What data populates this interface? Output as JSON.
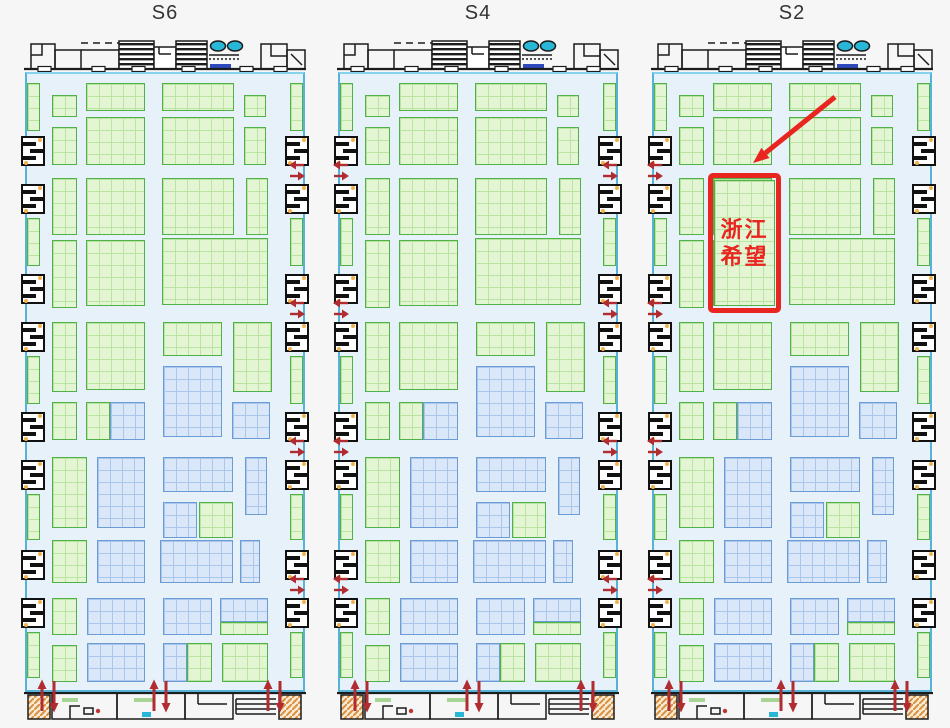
{
  "page": {
    "background": "#f6f6f6"
  },
  "panels": [
    {
      "label": "S6",
      "x": 22
    },
    {
      "label": "S4",
      "x": 335
    },
    {
      "label": "S2",
      "x": 649,
      "highlight": {
        "full_text": "浙江希望",
        "lines": [
          "浙江",
          "希望"
        ],
        "rect": [
          59,
          173,
          73,
          140
        ],
        "booth": [
          65,
          180,
          61,
          126
        ],
        "arrow": {
          "from": [
            186,
            97
          ],
          "to": [
            104,
            163
          ]
        }
      }
    }
  ],
  "colors": {
    "page_bg": "#f6f6f6",
    "hall_bg": "#e6f1fa",
    "hall_border": "#55b2d9",
    "green_fill": "#e3f5d3",
    "green_border": "#4fb148",
    "blue_fill": "#d9e7f8",
    "blue_border": "#6b9cd6",
    "arrow_red": "#b02c30",
    "highlight_red": "#e8251f",
    "cyan_fixture": "#28b7d7",
    "stair_orange": "#d98f3e",
    "escalator_blue": "#2d49bb",
    "wall_black": "#1c1c1c"
  },
  "icons": {
    "two_way_arrow": "two-way-arrow-icon",
    "up_down_arrow": "up-down-arrow-icon",
    "annotation_arrow": "annotation-arrow-icon"
  },
  "floorplan": {
    "hall": {
      "left": 3,
      "top": 72,
      "width": 280,
      "height": 620
    },
    "booths": [
      [
        30,
        95,
        25,
        22,
        "g"
      ],
      [
        30,
        127,
        25,
        38,
        "g"
      ],
      [
        64,
        83,
        59,
        28,
        "g"
      ],
      [
        64,
        117,
        59,
        48,
        "g"
      ],
      [
        140,
        83,
        72,
        28,
        "g"
      ],
      [
        140,
        117,
        72,
        48,
        "g"
      ],
      [
        222,
        95,
        22,
        22,
        "g"
      ],
      [
        222,
        127,
        22,
        38,
        "g"
      ],
      [
        30,
        178,
        25,
        57,
        "g"
      ],
      [
        64,
        178,
        59,
        57,
        "g"
      ],
      [
        140,
        178,
        72,
        57,
        "g"
      ],
      [
        224,
        178,
        22,
        57,
        "g"
      ],
      [
        30,
        240,
        25,
        68,
        "g"
      ],
      [
        64,
        240,
        59,
        66,
        "g"
      ],
      [
        140,
        238,
        106,
        67,
        "g"
      ],
      [
        30,
        322,
        25,
        70,
        "g"
      ],
      [
        64,
        322,
        59,
        68,
        "g"
      ],
      [
        141,
        322,
        59,
        34,
        "g"
      ],
      [
        141,
        366,
        59,
        71,
        "b"
      ],
      [
        211,
        322,
        39,
        70,
        "g"
      ],
      [
        30,
        402,
        25,
        38,
        "g"
      ],
      [
        64,
        402,
        24,
        38,
        "g"
      ],
      [
        88,
        402,
        35,
        38,
        "b"
      ],
      [
        210,
        402,
        38,
        37,
        "b"
      ],
      [
        30,
        457,
        35,
        71,
        "g"
      ],
      [
        75,
        457,
        48,
        71,
        "b"
      ],
      [
        141,
        457,
        70,
        35,
        "b"
      ],
      [
        141,
        502,
        34,
        36,
        "b"
      ],
      [
        177,
        502,
        34,
        36,
        "g"
      ],
      [
        223,
        457,
        22,
        58,
        "b"
      ],
      [
        30,
        540,
        35,
        43,
        "g"
      ],
      [
        75,
        540,
        48,
        43,
        "b"
      ],
      [
        138,
        540,
        73,
        43,
        "b"
      ],
      [
        218,
        540,
        20,
        43,
        "b"
      ],
      [
        30,
        598,
        25,
        37,
        "g"
      ],
      [
        65,
        598,
        58,
        37,
        "b"
      ],
      [
        141,
        598,
        49,
        37,
        "b"
      ],
      [
        198,
        598,
        48,
        24,
        "b"
      ],
      [
        198,
        622,
        48,
        13,
        "g"
      ],
      [
        30,
        645,
        25,
        37,
        "g"
      ],
      [
        65,
        643,
        58,
        39,
        "b"
      ],
      [
        141,
        643,
        24,
        39,
        "b"
      ],
      [
        165,
        643,
        25,
        39,
        "g"
      ],
      [
        200,
        643,
        46,
        39,
        "g"
      ]
    ],
    "side_green": [
      [
        83,
        48
      ],
      [
        218,
        48
      ],
      [
        356,
        48
      ],
      [
        494,
        46
      ],
      [
        632,
        46
      ]
    ],
    "side_green_x": {
      "left": 5,
      "right": 268,
      "width": 13
    },
    "side_black": [
      136,
      184,
      274,
      322,
      412,
      460,
      550,
      598
    ],
    "side_black_x": {
      "left": -1,
      "right": 263
    },
    "arrow_rows": [
      170,
      308,
      446,
      584
    ],
    "gap_arrow_x": [
      288,
      332,
      601,
      646
    ],
    "bottom_arrows": [
      14,
      126,
      240
    ]
  }
}
